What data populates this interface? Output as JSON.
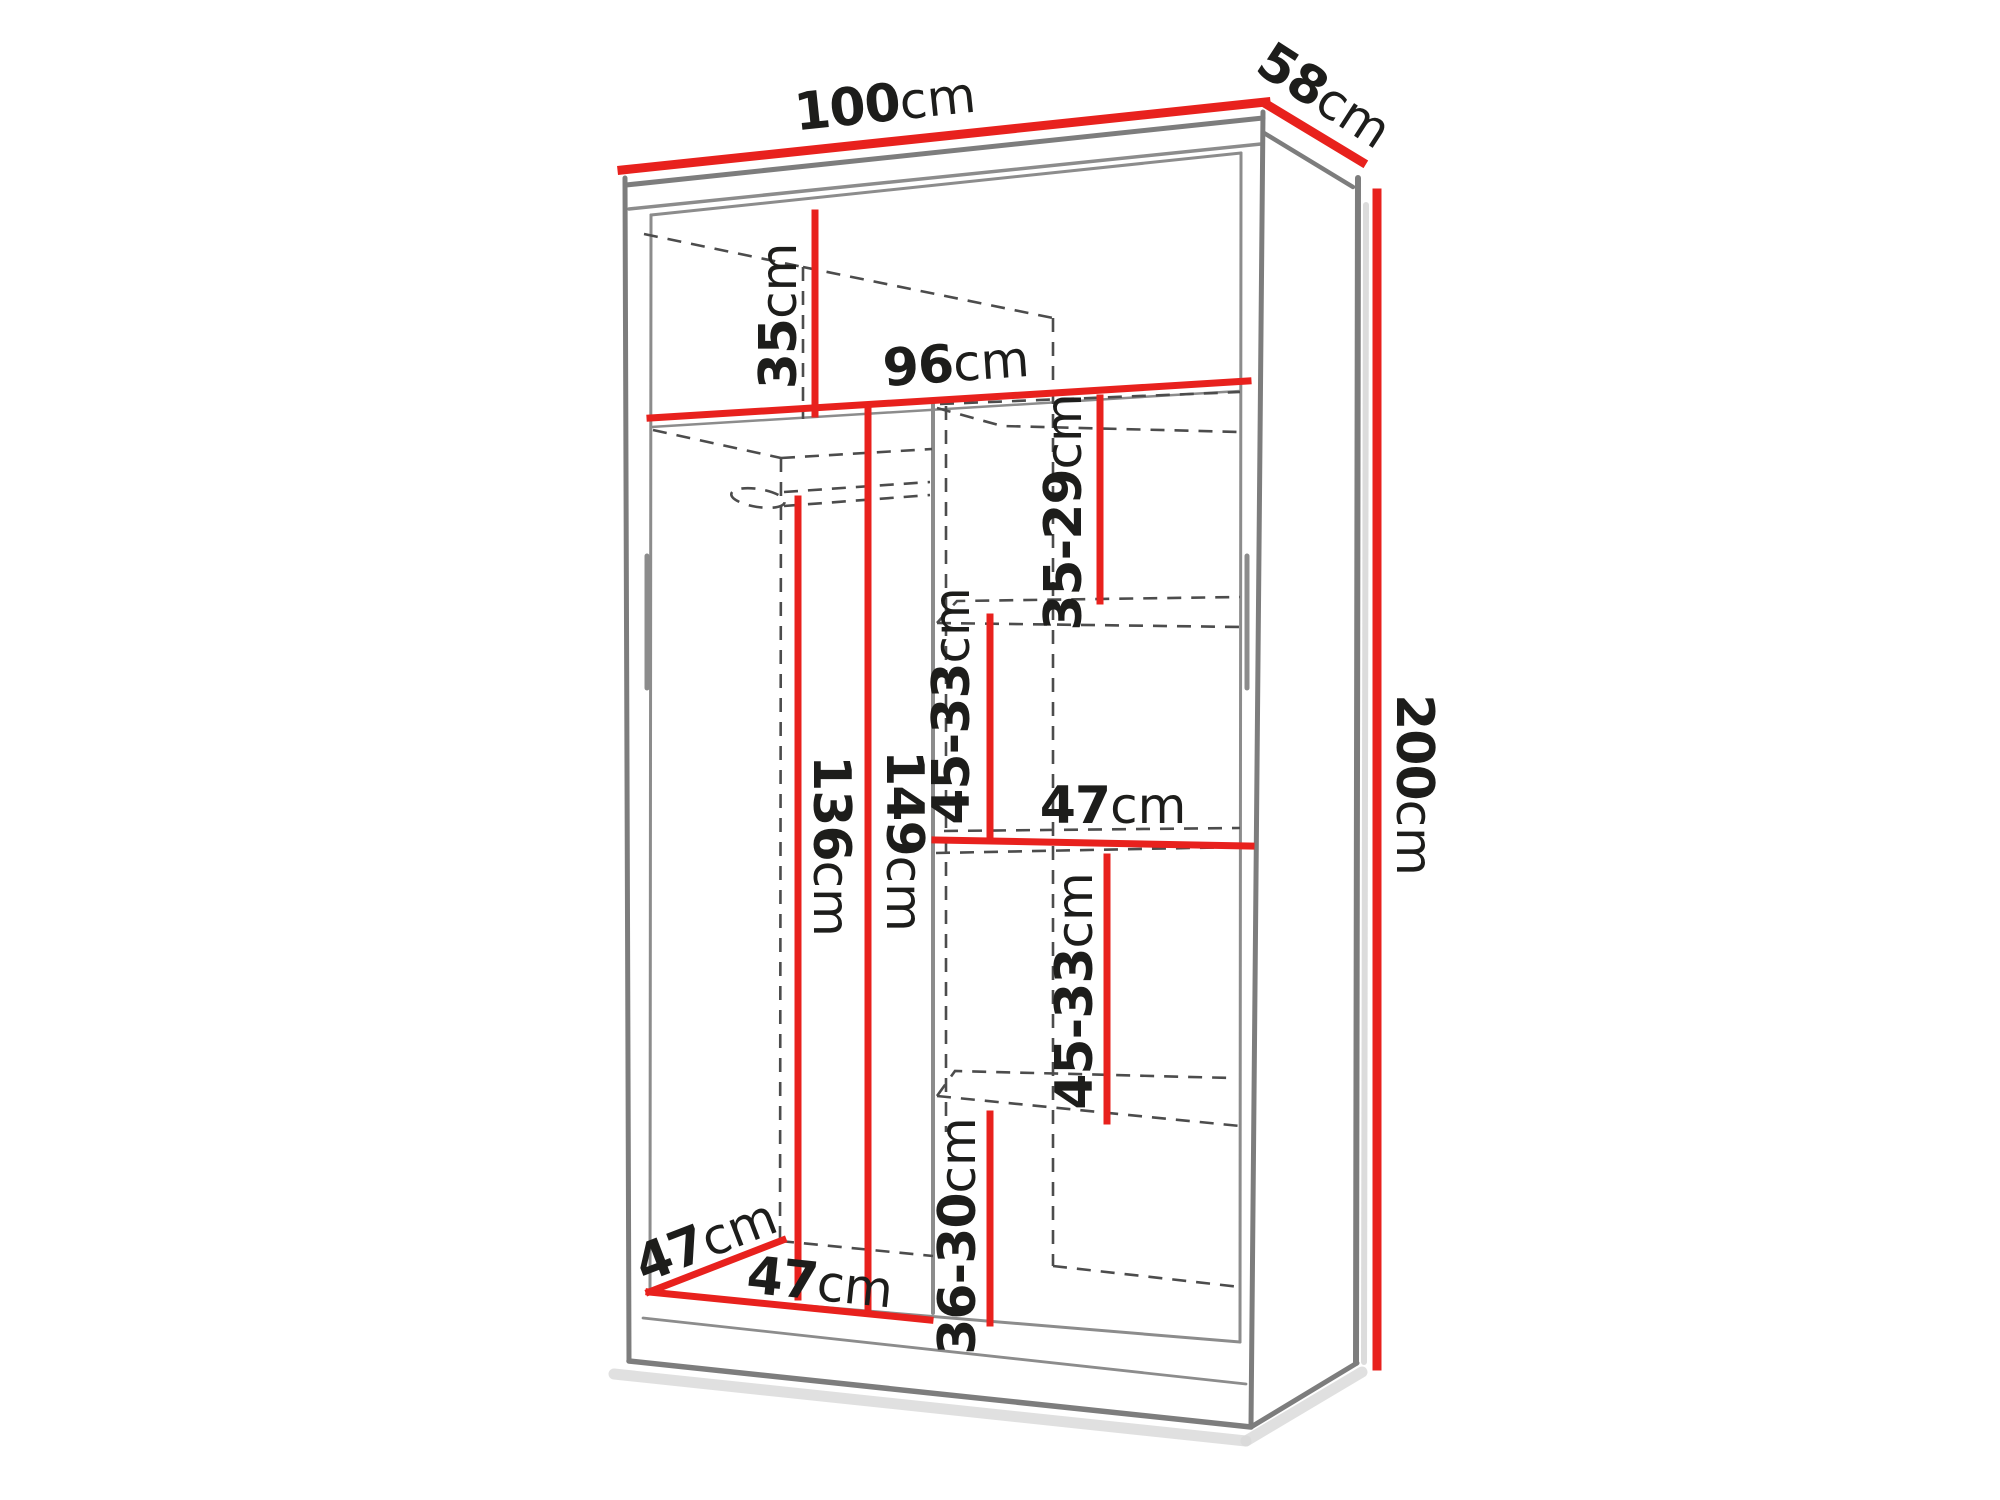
{
  "diagram": {
    "title": "Sliding wardrobe dimension diagram",
    "unit": "cm",
    "colors": {
      "dimension_line": "#e8211d",
      "edge_gray": "#7d7d7d",
      "dashed_gray": "#4c4c4c",
      "label_text": "#1d1d1b",
      "background": "#ffffff"
    },
    "overall_dimensions": {
      "width_cm": 100,
      "depth_cm": 58,
      "height_cm": 200
    },
    "labels": {
      "width": {
        "value": "100",
        "unit": "cm"
      },
      "depth": {
        "value": "58",
        "unit": "cm"
      },
      "height": {
        "value": "200",
        "unit": "cm"
      },
      "top_shelf": {
        "value": "35",
        "unit": "cm"
      },
      "interior_width": {
        "value": "96",
        "unit": "cm"
      },
      "gap_upper_right": {
        "value": "35-29",
        "unit": "cm"
      },
      "gap_mid_right": {
        "value": "45-33",
        "unit": "cm"
      },
      "shelf_width": {
        "value": "47",
        "unit": "cm"
      },
      "hang_inner": {
        "value": "136",
        "unit": "cm"
      },
      "hang_outer": {
        "value": "149",
        "unit": "cm"
      },
      "gap_lower_right": {
        "value": "45-33",
        "unit": "cm"
      },
      "gap_bottom_right": {
        "value": "36-30",
        "unit": "cm"
      },
      "left_depth": {
        "value": "47",
        "unit": "cm"
      },
      "left_width": {
        "value": "47",
        "unit": "cm"
      }
    }
  }
}
